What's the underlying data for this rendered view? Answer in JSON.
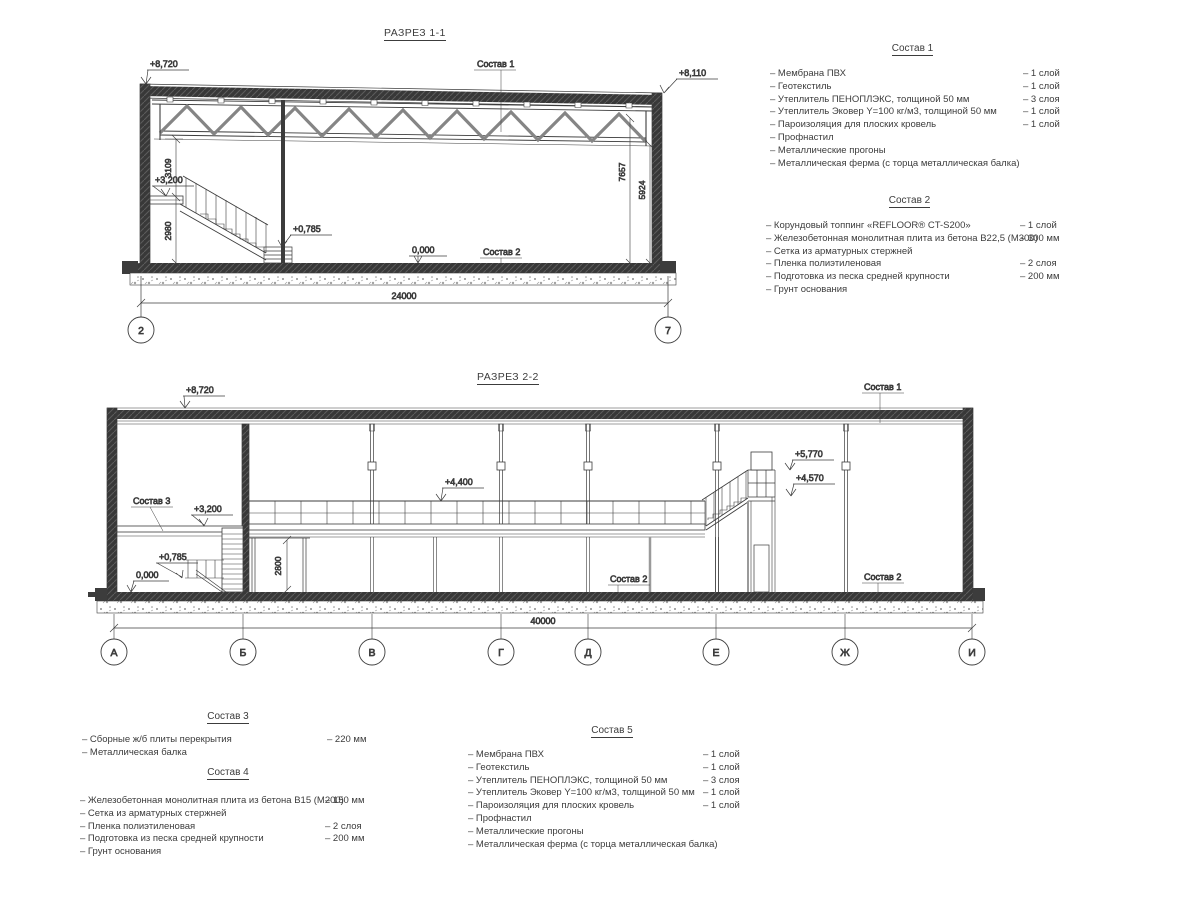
{
  "colors": {
    "ink": "#3c3c3c",
    "wall_fill": "#383838",
    "steel_gray": "#858585",
    "partition_gray": "#9a9a9a",
    "paper": "#ffffff"
  },
  "section1": {
    "title": "РАЗРЕЗ 1-1",
    "marks": {
      "top_left": "+8,720",
      "top_right": "+8,110",
      "mezz": "+3,200",
      "entry": "+0,785",
      "zero": "0,000"
    },
    "refs": {
      "roof": "Состав 1",
      "floor": "Состав 2"
    },
    "dims": {
      "h_upper": "3109",
      "h_lower": "2980",
      "v_right1": "7657",
      "v_right2": "5924",
      "span": "24000"
    },
    "axes": [
      "2",
      "7"
    ]
  },
  "section2": {
    "title": "РАЗРЕЗ 2-2",
    "marks": {
      "top_left": "+8,720",
      "walkway": "+4,400",
      "stair_top": "+5,770",
      "stair_mid": "+4,570",
      "mezz": "+3,200",
      "entry": "+0,785",
      "zero": "0,000"
    },
    "refs": {
      "roof": "Состав 1",
      "slab": "Состав 3",
      "floor_mid": "Состав 2",
      "floor_right": "Состав 2"
    },
    "dims": {
      "door": "2800",
      "span": "40000"
    },
    "axes": [
      "А",
      "Б",
      "В",
      "Г",
      "Д",
      "Е",
      "Ж",
      "И"
    ]
  },
  "compositions": [
    {
      "title": "Состав 1",
      "items": [
        {
          "name": "– Мембрана ПВХ",
          "value": "– 1 слой"
        },
        {
          "name": "– Геотекстиль",
          "value": "– 1 слой"
        },
        {
          "name": "– Утеплитель ПЕНОПЛЭКС, толщиной 50 мм",
          "value": "– 3 слоя"
        },
        {
          "name": "– Утеплитель Эковер Y=100 кг/м3, толщиной 50 мм",
          "value": "– 1 слой"
        },
        {
          "name": "– Пароизоляция для плоских кровель",
          "value": "– 1 слой"
        },
        {
          "name": "– Профнастил",
          "value": ""
        },
        {
          "name": "– Металлические прогоны",
          "value": ""
        },
        {
          "name": "– Металлическая ферма (с торца металлическая балка)",
          "value": ""
        }
      ]
    },
    {
      "title": "Состав 2",
      "items": [
        {
          "name": "– Корундовый топпинг «REFLOOR® CT-S200»",
          "value": "– 1 слой"
        },
        {
          "name": "– Железобетонная монолитная плита из бетона В22,5 (М300)",
          "value": "– 300 мм"
        },
        {
          "name": "– Сетка из арматурных стержней",
          "value": ""
        },
        {
          "name": "– Пленка полиэтиленовая",
          "value": "– 2 слоя"
        },
        {
          "name": "– Подготовка из песка средней крупности",
          "value": "– 200 мм"
        },
        {
          "name": "– Грунт основания",
          "value": ""
        }
      ]
    },
    {
      "title": "Состав 3",
      "items": [
        {
          "name": "– Сборные ж/б плиты перекрытия",
          "value": "– 220 мм"
        },
        {
          "name": "– Металлическая балка",
          "value": ""
        }
      ]
    },
    {
      "title": "Состав 4",
      "items": [
        {
          "name": "– Железобетонная монолитная плита из бетона В15 (М200)",
          "value": "– 150 мм"
        },
        {
          "name": "– Сетка из арматурных стержней",
          "value": ""
        },
        {
          "name": "– Пленка полиэтиленовая",
          "value": "– 2 слоя"
        },
        {
          "name": "– Подготовка из песка средней крупности",
          "value": "– 200 мм"
        },
        {
          "name": "– Грунт основания",
          "value": ""
        }
      ]
    },
    {
      "title": "Состав 5",
      "items": [
        {
          "name": "– Мембрана ПВХ",
          "value": "– 1 слой"
        },
        {
          "name": "– Геотекстиль",
          "value": "– 1 слой"
        },
        {
          "name": "– Утеплитель ПЕНОПЛЭКС, толщиной 50 мм",
          "value": "– 3 слоя"
        },
        {
          "name": "– Утеплитель Эковер Y=100 кг/м3, толщиной 50 мм",
          "value": "– 1 слой"
        },
        {
          "name": "– Пароизоляция для плоских кровель",
          "value": "– 1 слой"
        },
        {
          "name": "– Профнастил",
          "value": ""
        },
        {
          "name": "– Металлические прогоны",
          "value": ""
        },
        {
          "name": "– Металлическая ферма (с торца металлическая балка)",
          "value": ""
        }
      ]
    }
  ]
}
